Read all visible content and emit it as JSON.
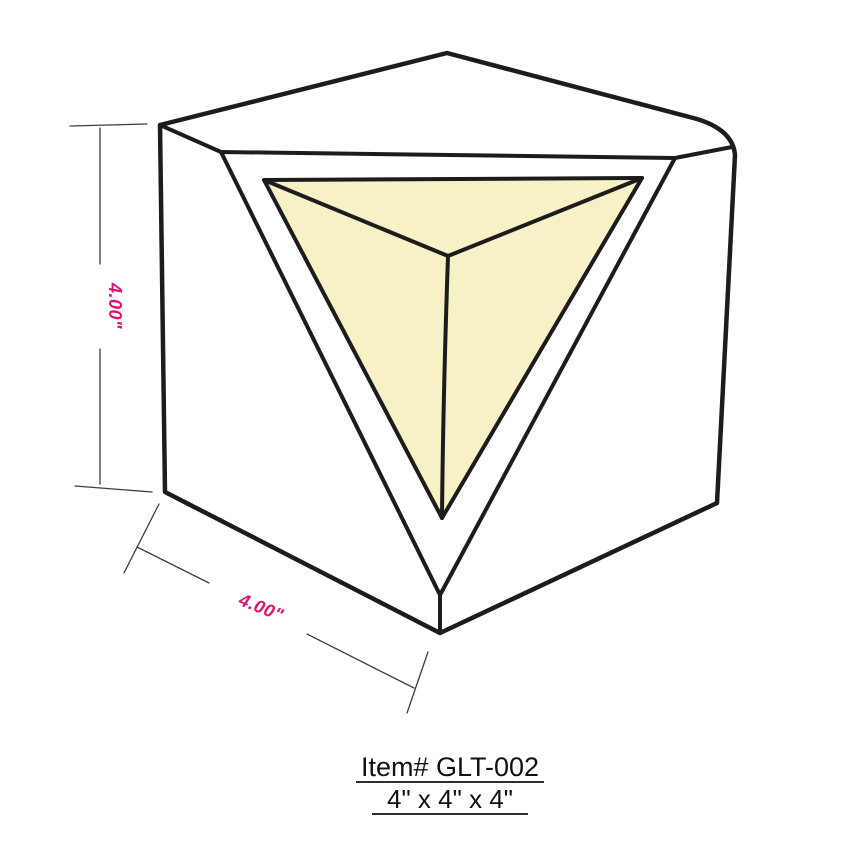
{
  "drawing": {
    "caption": {
      "line1": "Item# GLT-002",
      "line2": "4\" x 4\" x 4\""
    },
    "dimensions": {
      "height": {
        "label": "4.00\"",
        "orientation": "vertical"
      },
      "width": {
        "label": "4.00\"",
        "orientation": "diagonal"
      }
    },
    "shape": "cube-with-concave-corner-recess"
  },
  "colors": {
    "outline": "#1c1c1c",
    "recess_fill": "#f8f1c5",
    "dimension_line": "#3f3f3f",
    "dimension_text": "#e2106e",
    "caption_text": "#111111",
    "background": "#ffffff"
  }
}
